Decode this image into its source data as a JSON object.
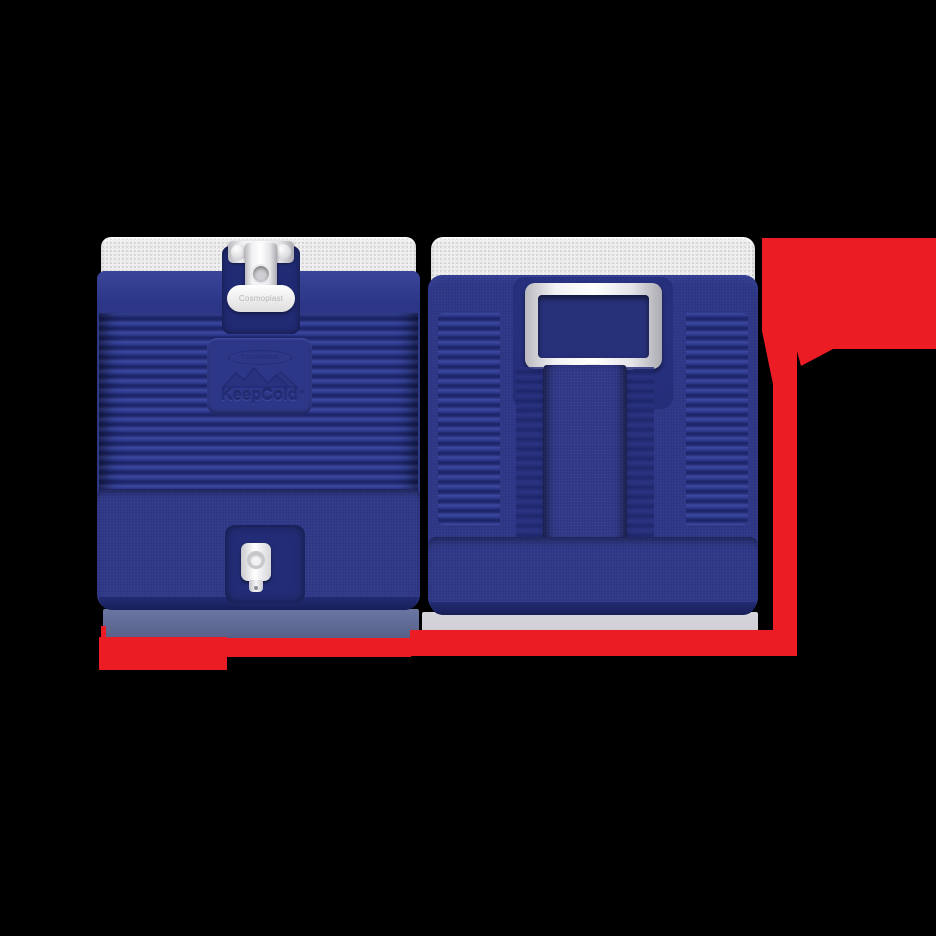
{
  "scene": {
    "type": "product-render",
    "description": "Two navy blue insulated water-cooler renders (front view with latch and spigot, rear view with carry handle) on a black background, with red dimension marker lines along the bottom and right side",
    "background_color": "#000000"
  },
  "front_cooler": {
    "view": "front",
    "latch_label": "Cosmoplast",
    "logo": {
      "brand": "Cosmoplast",
      "name": "KeepCold",
      "registered_mark": "®",
      "emblem": "mountains-icon"
    },
    "features": [
      "white-lid",
      "metal-latch",
      "ribbed-body",
      "embossed-logo",
      "white-spigot"
    ]
  },
  "back_cooler": {
    "view": "rear",
    "features": [
      "white-lid",
      "swing-carry-handle",
      "ribbed-sides",
      "center-strap-channel"
    ]
  },
  "annotations": {
    "dimension_marker_bottom": "horizontal red line under both coolers",
    "dimension_marker_right": "vertical red line with large red marker at top right"
  },
  "colors": {
    "body_navy": "#2b3484",
    "rib_highlight": "#3d499f",
    "rib_shadow": "#1b2466",
    "lid_white": "#f3f3f4",
    "hardware_silver": "#e8e8ec",
    "dimension_red": "#ec1c24",
    "shadow_left": "#646e97",
    "shadow_right": "#d2d2d8",
    "background": "#000000"
  }
}
